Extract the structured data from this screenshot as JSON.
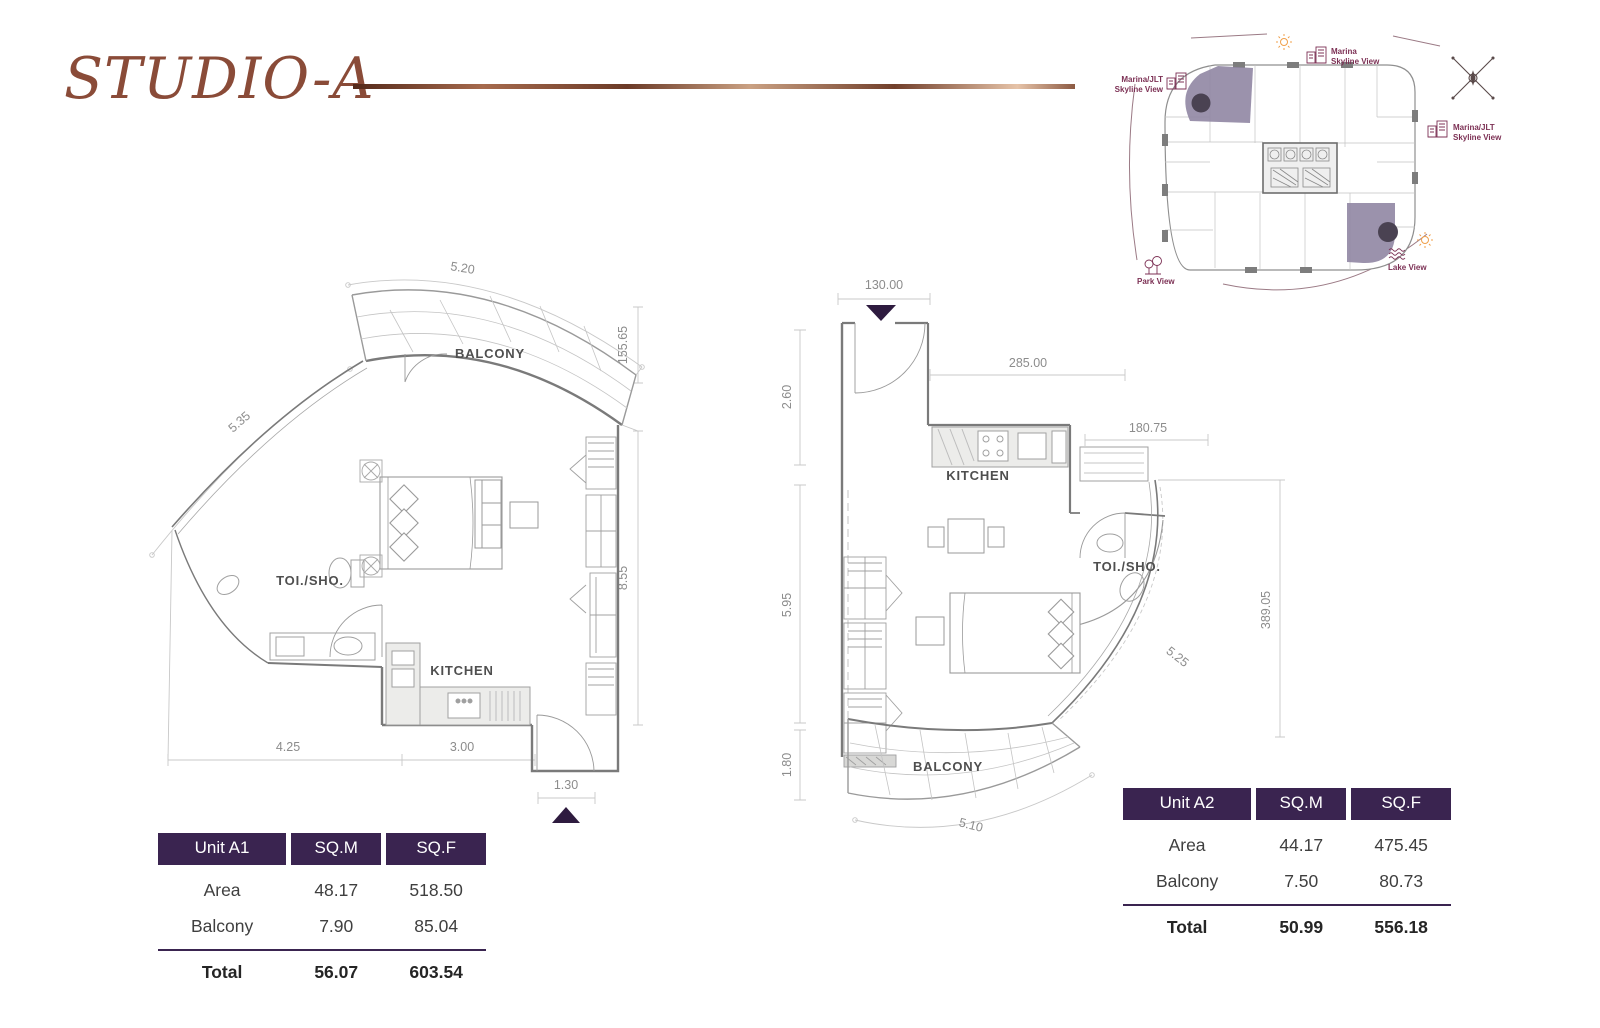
{
  "title": "STUDIO-A",
  "key_plan": {
    "top_line1": "Marina",
    "top_line2": "Skyline View",
    "left_line1": "Marina/JLT",
    "left_line2": "Skyline View",
    "right_line1": "Marina/JLT",
    "right_line2": "Skyline View",
    "lake": "Lake View",
    "park": "Park View"
  },
  "plan_a1": {
    "balcony": "BALCONY",
    "toilet": "TOI./SHO.",
    "kitchen": "KITCHEN",
    "dim_top": "5.20",
    "dim_diag": "5.35",
    "dim_right_top": "155.65",
    "dim_right": "8.55",
    "dim_bottom_left": "4.25",
    "dim_bottom_mid": "3.00",
    "dim_entry": "1.30"
  },
  "plan_a2": {
    "balcony": "BALCONY",
    "toilet": "TOI./SHO.",
    "kitchen": "KITCHEN",
    "dim_entry": "130.00",
    "dim_left_top": "2.60",
    "dim_top": "285.00",
    "dim_mid": "180.75",
    "dim_left_mid": "5.95",
    "dim_left_bottom": "1.80",
    "dim_right": "389.05",
    "dim_diag": "5.25",
    "dim_bottom": "5.10"
  },
  "table_a1": {
    "header": [
      "Unit A1",
      "SQ.M",
      "SQ.F"
    ],
    "rows": [
      [
        "Area",
        "48.17",
        "518.50"
      ],
      [
        "Balcony",
        "7.90",
        "85.04"
      ]
    ],
    "total": [
      "Total",
      "56.07",
      "603.54"
    ]
  },
  "table_a2": {
    "header": [
      "Unit A2",
      "SQ.M",
      "SQ.F"
    ],
    "rows": [
      [
        "Area",
        "44.17",
        "475.45"
      ],
      [
        "Balcony",
        "7.50",
        "80.73"
      ]
    ],
    "total": [
      "Total",
      "50.99",
      "556.18"
    ]
  },
  "colors": {
    "title_brown": "#8a4b38",
    "table_header_purple": "#3a2450",
    "keyplan_label": "#7c3054",
    "unit_highlight": "#9086a3",
    "sun_orange": "#f0a04b",
    "entry_arrow": "#2e1b3f"
  }
}
